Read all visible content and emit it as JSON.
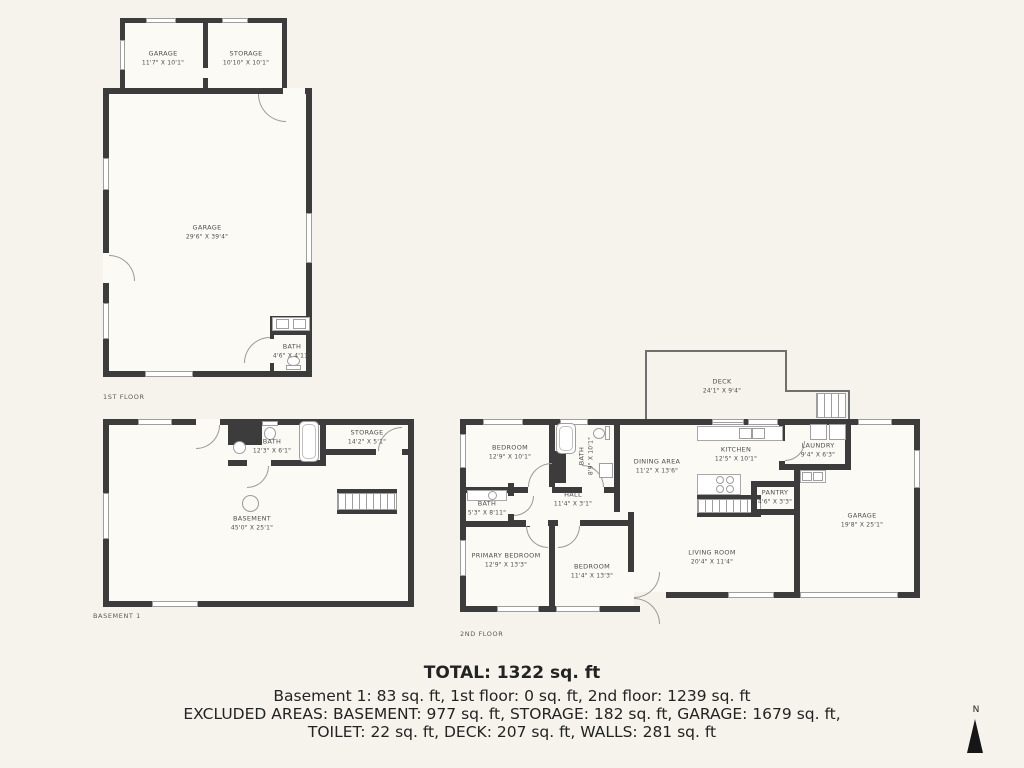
{
  "colors": {
    "background": "#f5f3ec",
    "wall": "#3c3c3c",
    "room_fill": "#fbfaf5",
    "label": "#4d4d4d"
  },
  "floors": {
    "first": {
      "label": "1ST FLOOR",
      "rooms": {
        "garage_outbuilding": {
          "name": "GARAGE",
          "dims": "11'7\" X 10'1\""
        },
        "storage": {
          "name": "STORAGE",
          "dims": "10'10\" X 10'1\""
        },
        "garage_main": {
          "name": "GARAGE",
          "dims": "29'6\" X 39'4\""
        },
        "bath": {
          "name": "BATH",
          "dims": "4'6\" X 4'11\""
        }
      }
    },
    "basement": {
      "label": "BASEMENT 1",
      "rooms": {
        "bath": {
          "name": "BATH",
          "dims": "12'3\" X 6'1\""
        },
        "storage": {
          "name": "STORAGE",
          "dims": "14'2\" X 5'1\""
        },
        "basement": {
          "name": "BASEMENT",
          "dims": "45'0\" X 25'1\""
        }
      }
    },
    "second": {
      "label": "2ND FLOOR",
      "rooms": {
        "deck": {
          "name": "DECK",
          "dims": "24'1\" X 9'4\""
        },
        "bedroom": {
          "name": "BEDROOM",
          "dims": "12'9\" X 10'1\""
        },
        "bath": {
          "name": "BATH",
          "dims": "8'9\" X 10'1\""
        },
        "bath_small": {
          "name": "BATH",
          "dims": "5'3\" X 8'11\""
        },
        "hall": {
          "name": "HALL",
          "dims": "11'4\" X 3'1\""
        },
        "dining": {
          "name": "DINING AREA",
          "dims": "11'2\" X 13'6\""
        },
        "kitchen": {
          "name": "KITCHEN",
          "dims": "12'5\" X 10'1\""
        },
        "laundry": {
          "name": "LAUNDRY",
          "dims": "9'4\" X 6'3\""
        },
        "pantry": {
          "name": "PANTRY",
          "dims": "4'6\" X 3'3\""
        },
        "primary_bedroom": {
          "name": "PRIMARY BEDROOM",
          "dims": "12'9\" X 13'3\""
        },
        "bedroom2": {
          "name": "BEDROOM",
          "dims": "11'4\" X 13'3\""
        },
        "living": {
          "name": "LIVING ROOM",
          "dims": "20'4\" X 11'4\""
        },
        "garage": {
          "name": "GARAGE",
          "dims": "19'8\" X 25'1\""
        }
      }
    }
  },
  "summary": {
    "total": "TOTAL: 1322 sq. ft",
    "floors_line": "Basement 1: 83 sq. ft, 1st floor: 0 sq. ft, 2nd floor: 1239 sq. ft",
    "excluded_line1": "EXCLUDED AREAS: BASEMENT: 977 sq. ft, STORAGE: 182 sq. ft, GARAGE: 1679 sq. ft,",
    "excluded_line2": "TOILET: 22 sq. ft, DECK: 207 sq. ft, WALLS: 281 sq. ft"
  },
  "compass": {
    "label": "N"
  }
}
